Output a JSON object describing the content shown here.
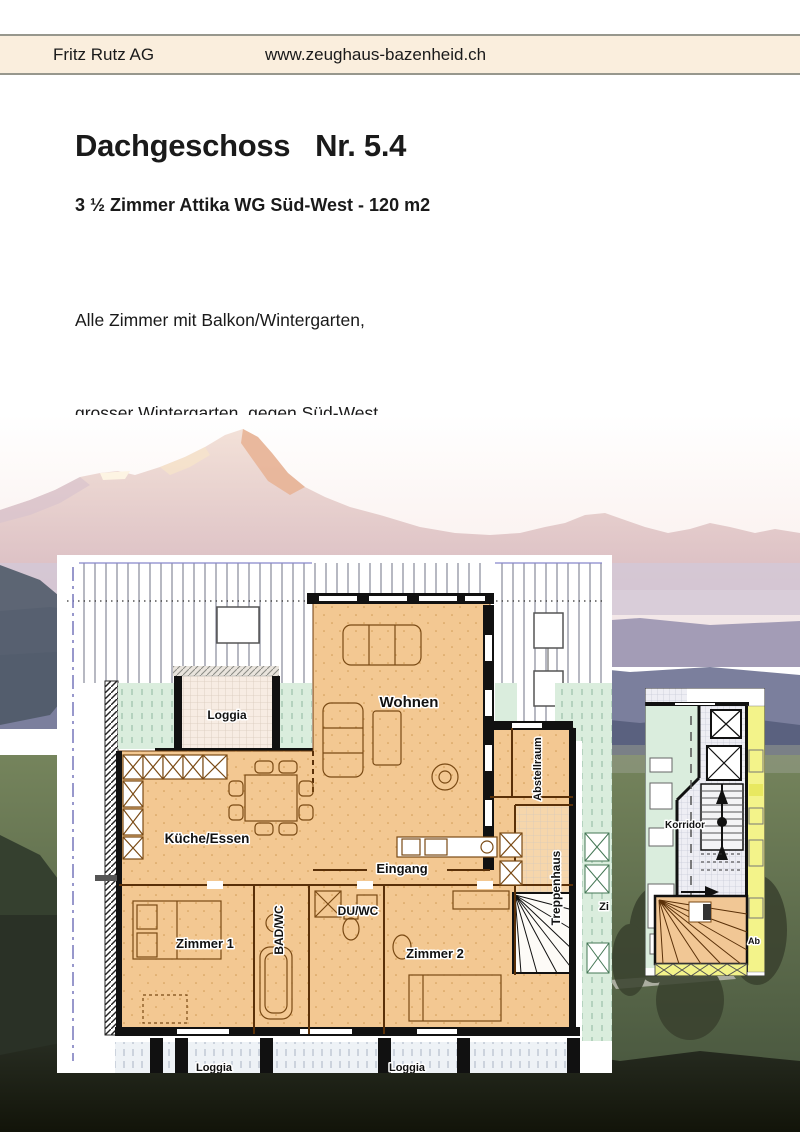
{
  "header": {
    "company": "Fritz Rutz AG",
    "website": "www.zeughaus-bazenheid.ch",
    "bg_color": "#faeedd"
  },
  "listing": {
    "title": "Dachgeschoss   Nr. 5.4",
    "subtitle": "3 ½ Zimmer Attika WG Süd-West - 120 m2",
    "description_lines": [
      "Alle Zimmer mit Balkon/Wintergarten,",
      "grosser Wintergarten  gegen Süd-West,",
      "separate Du/WC und Bad/WC,",
      "Abstellraum in Wohnung, mit Waschmaschine/Tumbler",
      "sehr sonnig mit guter Fernsicht"
    ]
  },
  "floorplan": {
    "rooms": {
      "loggia_top": "Loggia",
      "wohnen": "Wohnen",
      "kueche_essen": "Küche/Essen",
      "eingang": "Eingang",
      "bad_wc": "BAD/WC",
      "du_wc": "DU/WC",
      "zimmer1": "Zimmer 1",
      "zimmer2": "Zimmer 2",
      "abstellraum": "Abstellraum",
      "treppenhaus": "Treppenhaus",
      "loggia_bottom_left": "Loggia",
      "loggia_bottom_right": "Loggia",
      "neighbor_room_partial": "Zi"
    },
    "colors": {
      "apartment_orange": "#f3c892",
      "neighbor_mint": "#daeddd",
      "neighbor_yellow": "#f3f38a",
      "loggia_fill": "#f7ece3",
      "wall_black": "#111111",
      "wall_brown": "#5a3008"
    }
  },
  "stairwell_plan": {
    "korridor": "Korridor",
    "abstell_partial": "Ab"
  }
}
